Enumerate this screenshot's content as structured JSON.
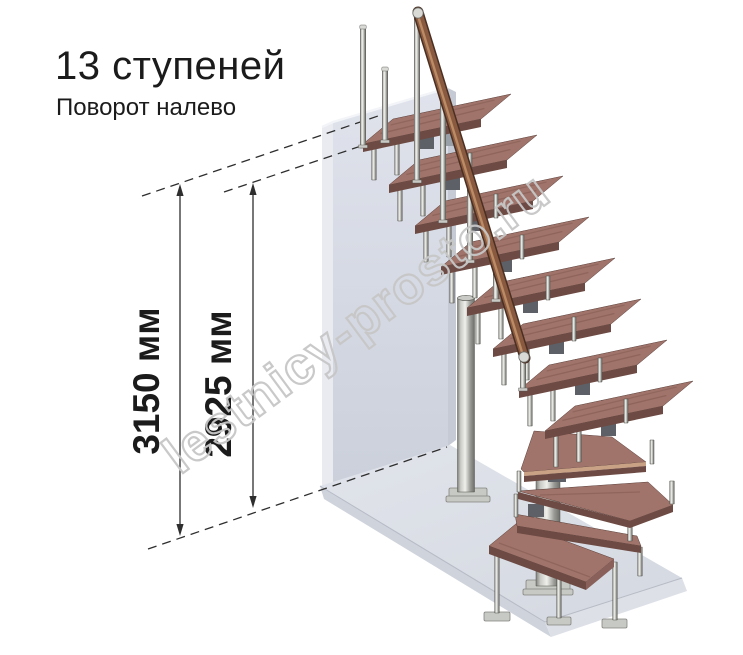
{
  "title": "13 ступеней",
  "subtitle": "Поворот налево",
  "dimensions": [
    {
      "value": "3150 мм"
    },
    {
      "value": "2925 мм"
    }
  ],
  "watermark": "lestnicy-prosto.ru",
  "colors": {
    "background": "#ffffff",
    "wall_face_top": "#e0e3ec",
    "wall_face_bottom": "#cbd0db",
    "wall_left": "#e9ebf1",
    "wall_right": "#c6cad4",
    "wall_topline": "#f2f4f8",
    "floor_top": "#e1e4eb",
    "floor_top_far": "#d5d9e1",
    "floor_front": "#cfd3dc",
    "floor_right": "#dde0e7",
    "floor_edge": "#b7bbc5",
    "tread_top": "#a0746a",
    "tread_front": "#6d4a43",
    "tread_side": "#8a615a",
    "tread_stripe": "#c9a184",
    "tread_outline": "#5a3f3a",
    "metal_dark": "#6e6e6a",
    "metal_mid": "#c9c9c5",
    "metal_light": "#efefeb",
    "metal_stroke": "#55544f",
    "plate": "#c6c9c4",
    "plate_stroke": "#84847f",
    "spine": "#5d6066",
    "spine_light": "#9aa0a8",
    "rail_dark": "#4a2f22",
    "rail_main": "#8a5a40",
    "rail_hi": "#bb8b65",
    "cap": "#d9d9d5",
    "cap_stroke": "#6a6a66",
    "dim": "#2e2e2e",
    "watermark_color": "#c7c7c7"
  }
}
